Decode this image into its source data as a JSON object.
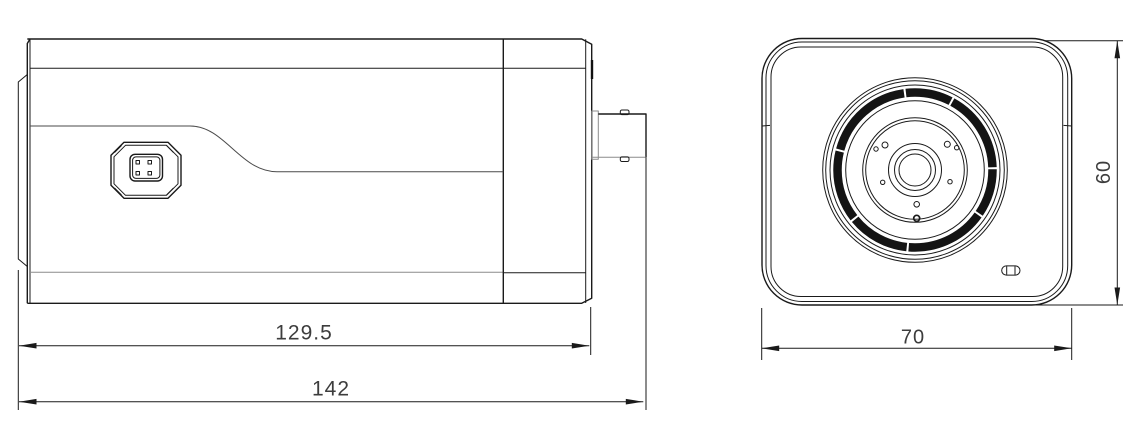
{
  "drawing": {
    "type": "technical-dimension-drawing",
    "subject": "box-camera",
    "views": {
      "side": {
        "name": "side-view",
        "dims": {
          "body_length": "129.5",
          "total_length": "142"
        }
      },
      "front": {
        "name": "front-view",
        "dims": {
          "width": "70",
          "height": "60"
        }
      }
    }
  },
  "colors": {
    "background": "#ffffff",
    "line": "#1a1a1a",
    "line_soft": "#8c8c8c",
    "dim_text": "#3d3d3d"
  }
}
